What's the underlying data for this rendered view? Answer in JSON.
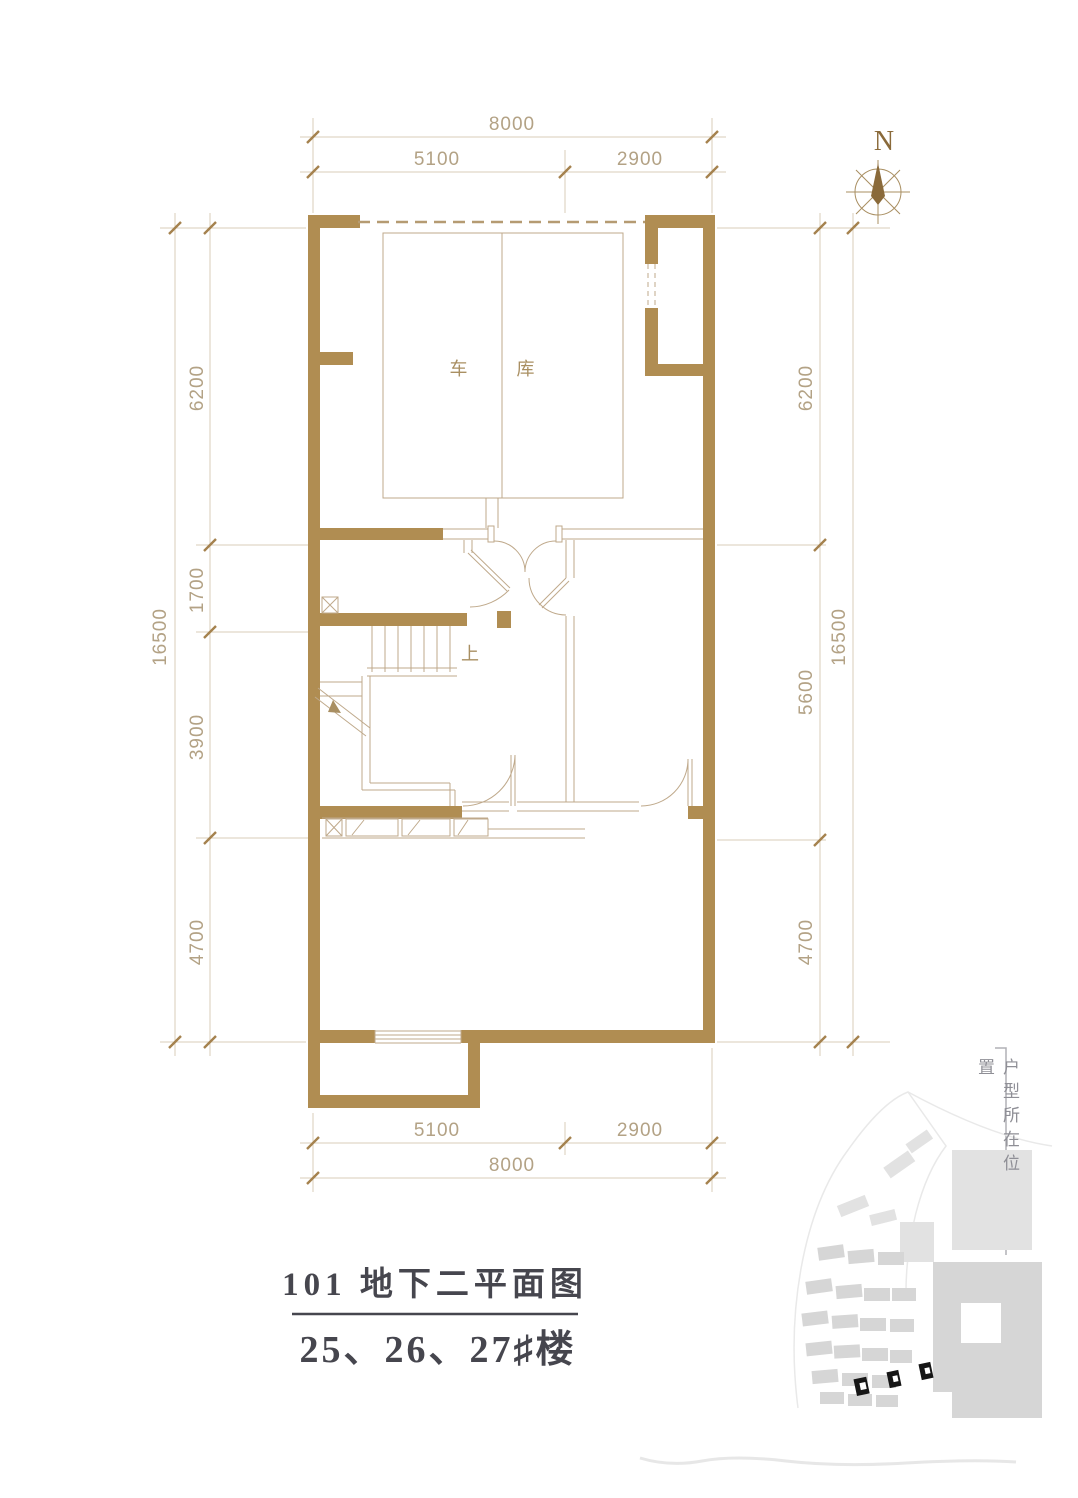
{
  "compass": {
    "label": "N"
  },
  "plan": {
    "garage_label": "车 库",
    "stairs_up_label": "上"
  },
  "dimensions": {
    "top": {
      "overall": "8000",
      "seg1": "5100",
      "seg2": "2900"
    },
    "bottom": {
      "overall": "8000",
      "seg1": "5100",
      "seg2": "2900"
    },
    "left": {
      "overall": "16500",
      "seg1": "6200",
      "seg2": "1700",
      "seg3": "3900",
      "seg4": "4700"
    },
    "right": {
      "overall": "16500",
      "seg1": "6200",
      "seg2": "5600",
      "seg3": "4700"
    }
  },
  "title_block": {
    "plan_title": "101 地下二平面图",
    "building_numbers": "25、26、27♯楼"
  },
  "locator": {
    "caption": "户型所在位置"
  },
  "colors": {
    "wall": "#b08d52",
    "thin_line": "#bfa98b",
    "dimension_text": "#b3a285",
    "title_text": "#46464e",
    "highlight_building": "#161616"
  }
}
